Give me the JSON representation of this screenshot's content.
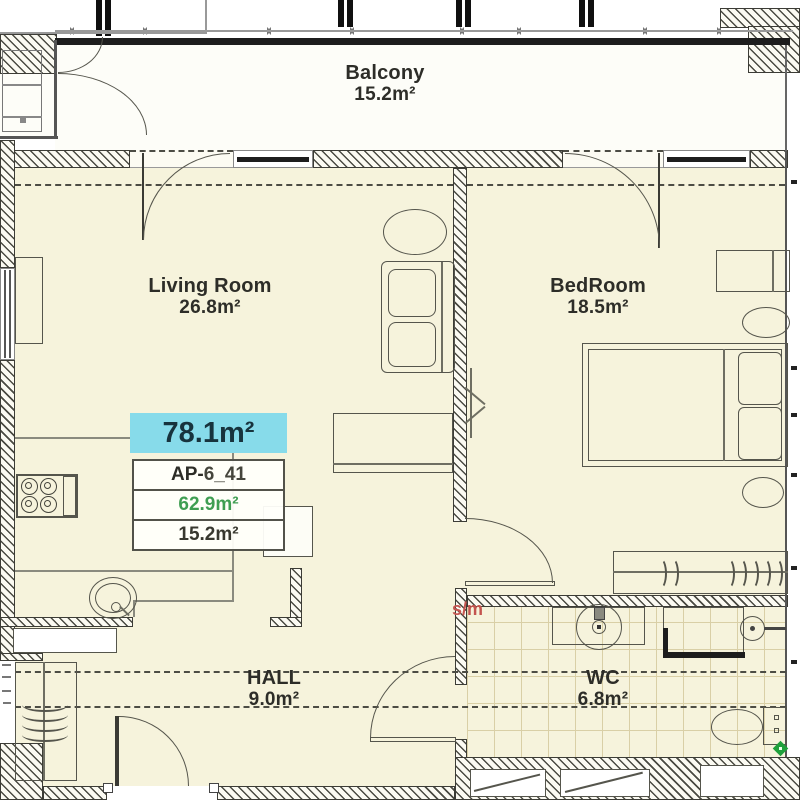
{
  "plan": {
    "highlight_area": "78.1m²",
    "unit": {
      "id_prefix": "AP-",
      "id_suffix": "6_41",
      "total_area": "62.9m²",
      "balcony_area": "15.2m²"
    },
    "rooms": [
      {
        "name": "Balcony",
        "area": "15.2m²"
      },
      {
        "name": "Living Room",
        "area": "26.8m²"
      },
      {
        "name": "BedRoom",
        "area": "18.5m²"
      },
      {
        "name": "HALL",
        "area": "9.0m²"
      },
      {
        "name": "WC",
        "area": "6.8m²"
      }
    ],
    "annotations": {
      "washing_machine_label": "s/m"
    },
    "colors": {
      "highlight": "#87dbea",
      "area_green": "#3f9e52",
      "annotation_red": "#c4544f",
      "floor": "#f6f3dc",
      "tile": "#d9cfa6"
    }
  }
}
